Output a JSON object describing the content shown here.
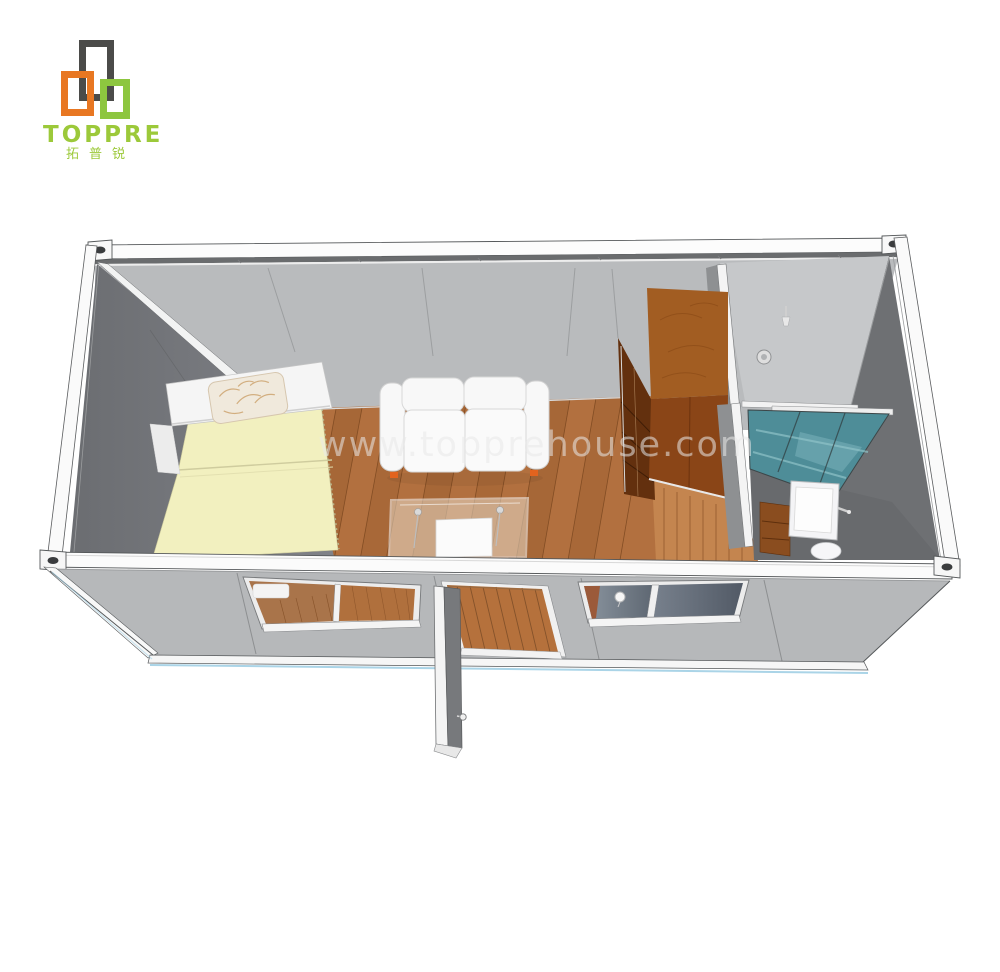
{
  "brand": {
    "name": "TOPPRE",
    "name_cn": "拓普锐",
    "logo_colors": {
      "dark": "#4b4b49",
      "orange": "#e87722",
      "green": "#8dc63f"
    },
    "text_color": "#9cc93a"
  },
  "watermark": {
    "text": "www.topprehouse.com",
    "color": "#e9e9e9"
  },
  "scene": {
    "type": "3d-render",
    "subject": "prefab flat-pack container house, roof removed, top-front cutaway view",
    "rooms": [
      "bedroom-living-area",
      "bathroom"
    ],
    "objects": [
      "single-bed-yellow-mattress",
      "patterned-pillow",
      "white-headboard-shelf",
      "white-loveseat-sofa",
      "glass-coffee-table",
      "wooden-wardrobe",
      "partition-wall",
      "glass-shower-screen",
      "washbasin",
      "toilet",
      "wood-plank-floor",
      "front-wall-two-sliding-windows",
      "open-entry-door",
      "steel-frame-with-corner-castings",
      "ceiling-downlight",
      "shower-head"
    ],
    "colors": {
      "back_wall": "#b9bbbd",
      "side_wall": "#75777b",
      "right_wall": "#6e7073",
      "ceiling": "#c6c8ca",
      "floor_wood": "#b2703f",
      "hallway_wood": "#c4854f",
      "bed": "#f2f0bf",
      "wardrobe": "#8a4517",
      "shower_glass": "#4e8d98",
      "frame": "#fbfbfb",
      "front_wall": "#b6b8ba",
      "shadow_blue": "#8ec6e0"
    }
  }
}
